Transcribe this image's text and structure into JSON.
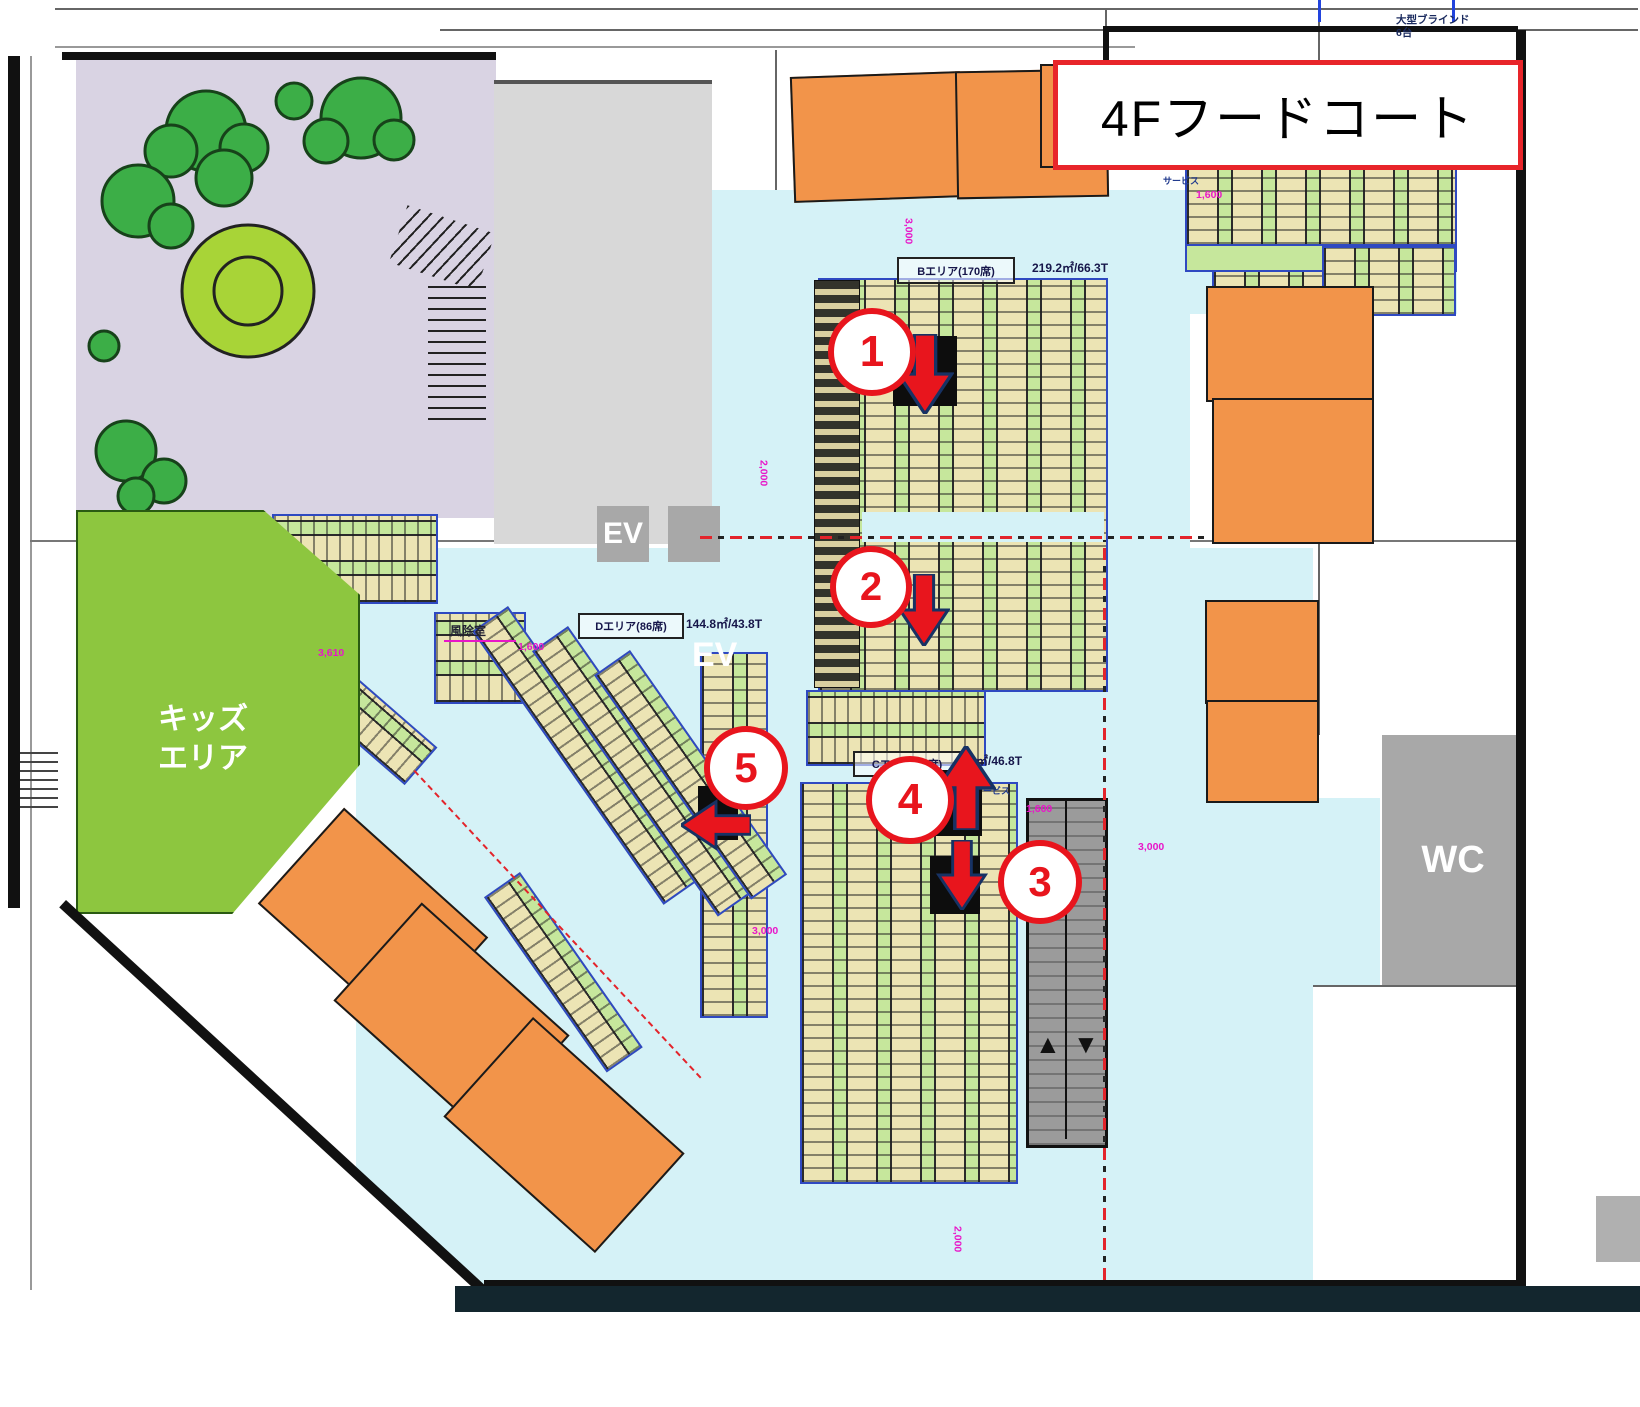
{
  "title": "4Fフードコート",
  "areas": {
    "b": {
      "name": "Bエリア(170席)",
      "stats": "219.2㎡/66.3T"
    },
    "d": {
      "name": "Dエリア(86席)",
      "stats": "144.8㎡/43.8T"
    },
    "c": {
      "name": "Cエリア(…席)",
      "stats": "㎡/46.8T"
    }
  },
  "kids": {
    "line1": "キッズ",
    "line2": "エリア"
  },
  "labels": {
    "ev": "EV",
    "ev2": "EV",
    "wc": "WC",
    "windbreak": "風除室",
    "blinds_line1": "大型ブラインド",
    "blinds_line2": "6台",
    "service1": "サービス",
    "service2": "サービス"
  },
  "markers": [
    {
      "label": "1",
      "direction": "down"
    },
    {
      "label": "2",
      "direction": "down"
    },
    {
      "label": "3",
      "direction": "down"
    },
    {
      "label": "4",
      "direction": "up"
    },
    {
      "label": "5",
      "direction": "left"
    }
  ],
  "dimensions": [
    "1,600",
    "3,000",
    "2,000",
    "1,200",
    "3,610",
    "1,600",
    "3,000",
    "2,000",
    "1,600",
    "3,000"
  ],
  "escalator": {
    "up": "▲",
    "down": "▼"
  },
  "colors": {
    "accent_red": "#e8151d",
    "floor_cyan": "#d5f2f7",
    "table_green": "#c6e79c",
    "kids_green": "#8dc63f",
    "tenant_orange": "#f2944a",
    "garden_lavender": "#d9d3e3",
    "gray": "#a8a8a8"
  }
}
